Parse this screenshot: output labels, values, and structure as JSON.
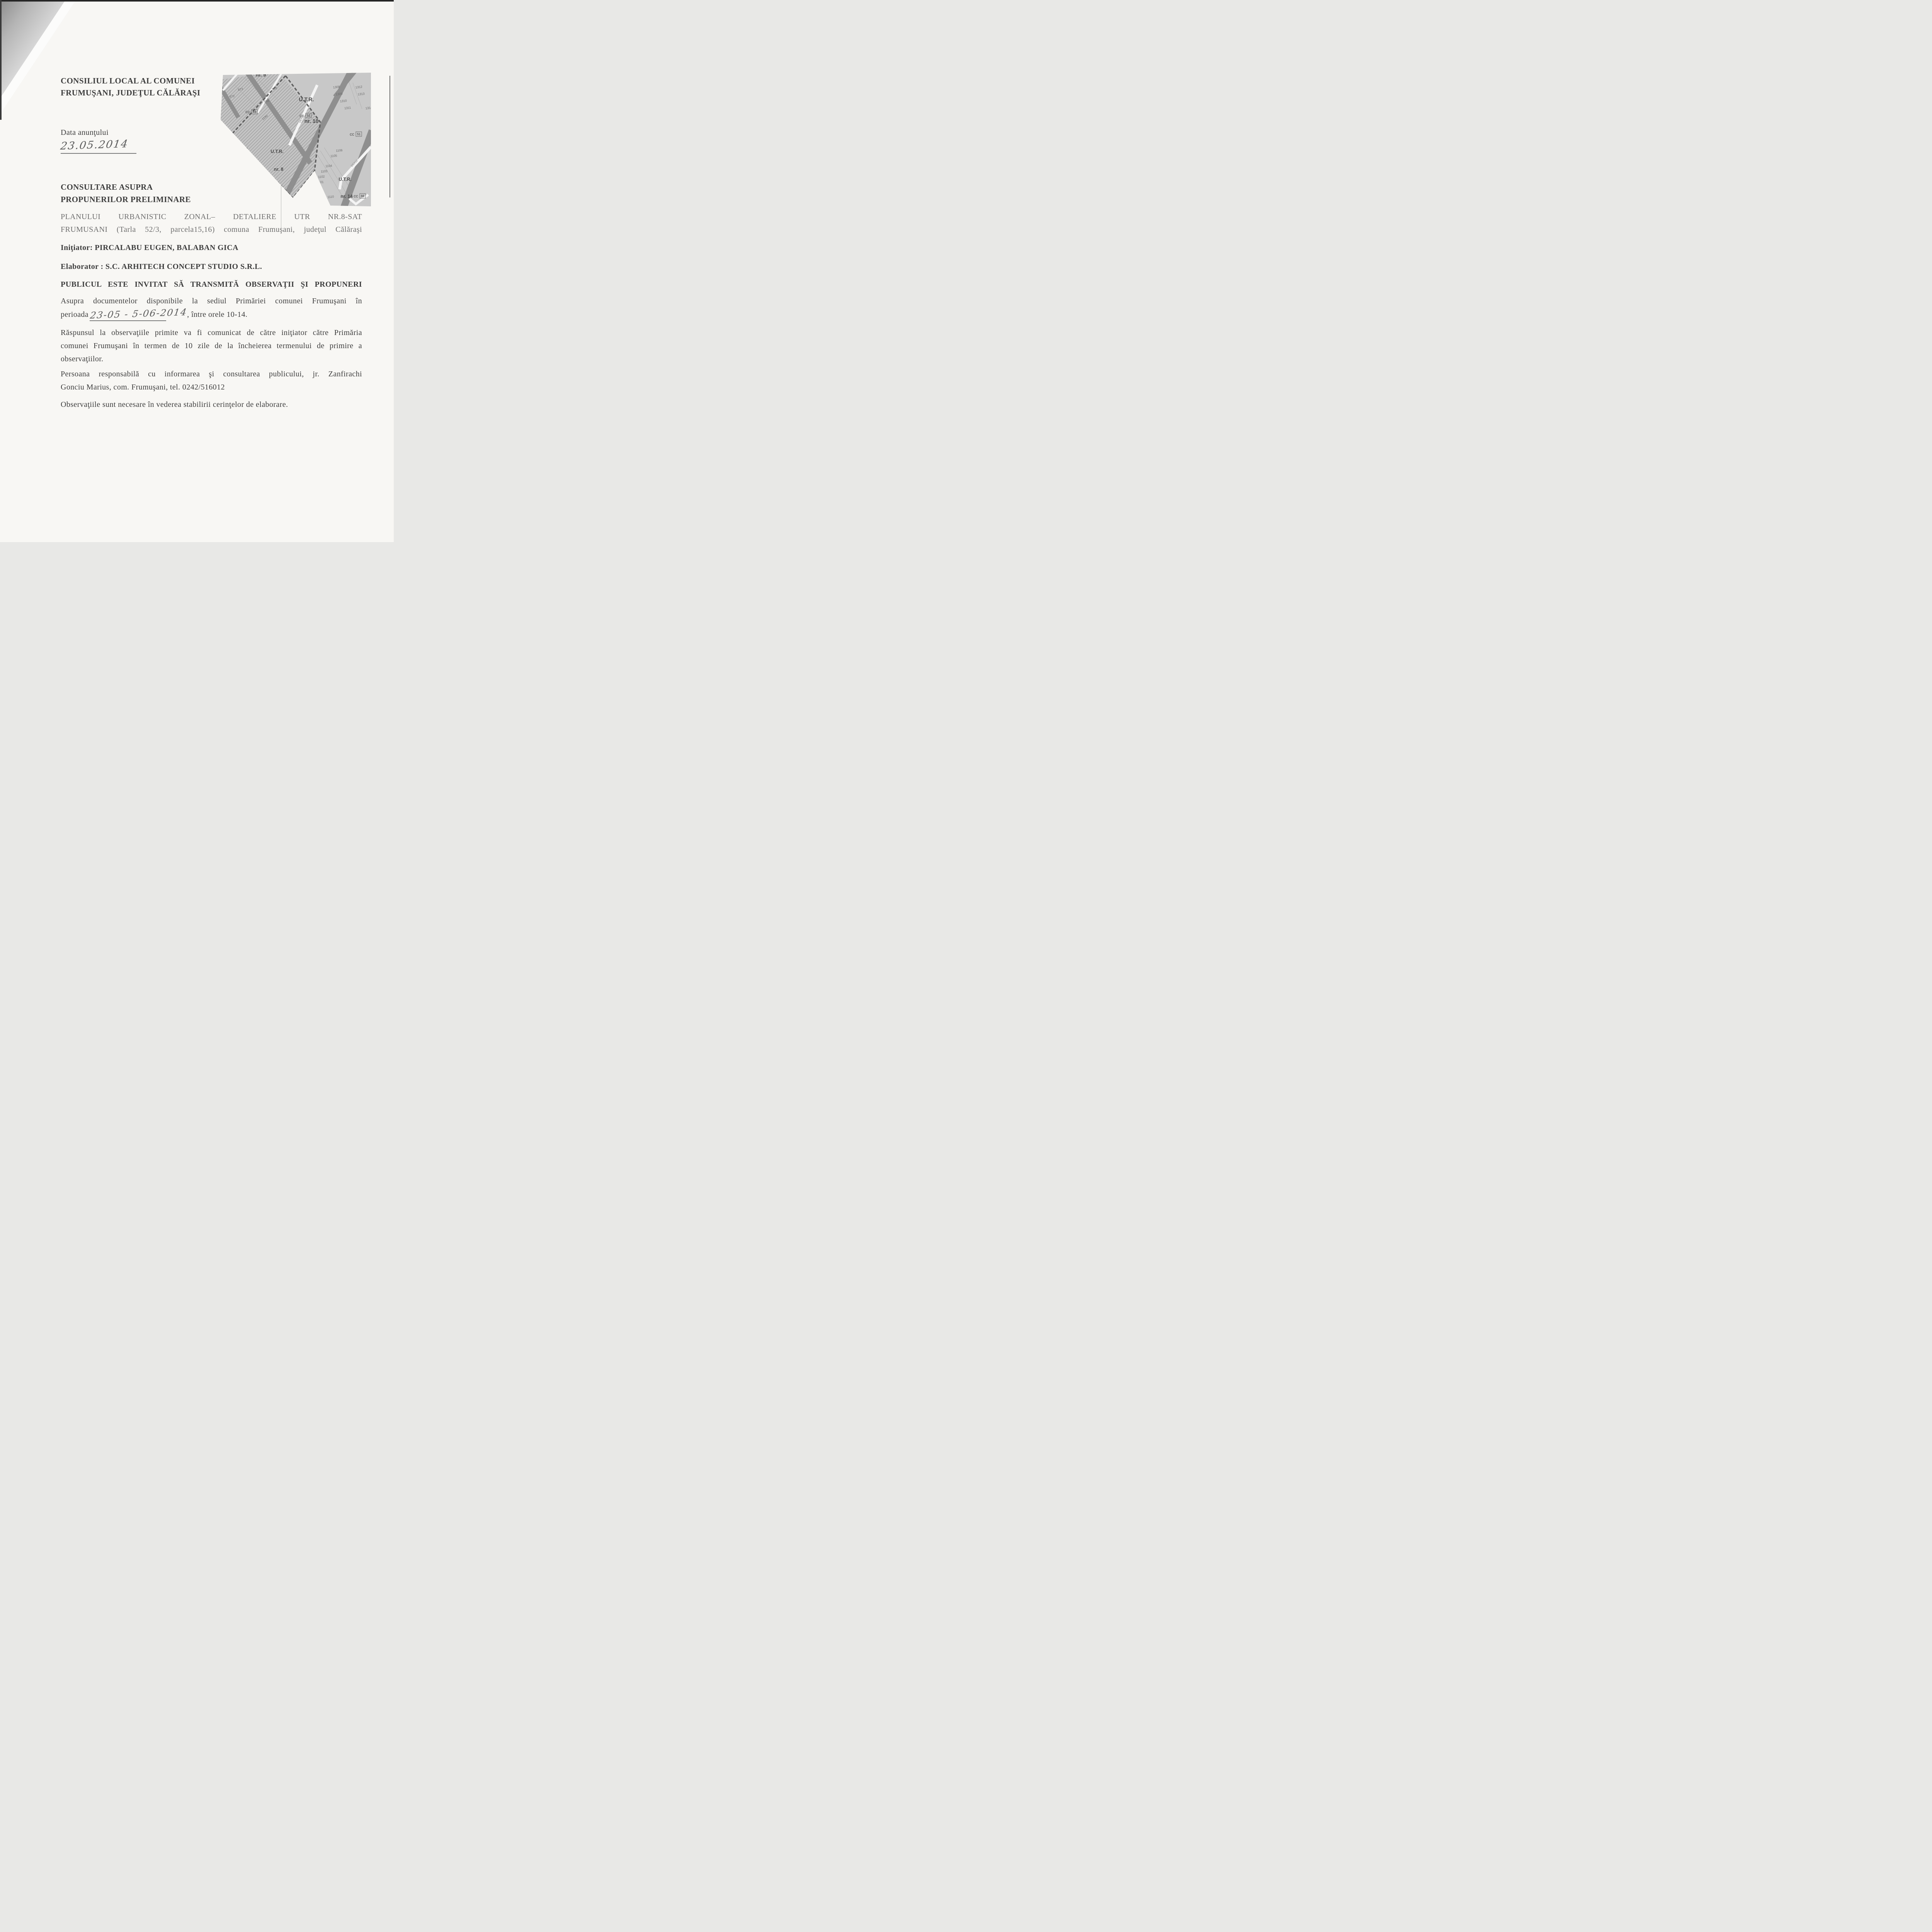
{
  "colors": {
    "paper": "#f8f7f4",
    "ink": "#3e3e3e",
    "faded_ink": "#6f6f6f",
    "handwriting": "#5d5d5d",
    "map_background": "#c8c8c8",
    "map_road": "#8f8f8f",
    "map_ink": "#474747"
  },
  "doc": {
    "header": [
      "CONSILIUL LOCAL AL COMUNEI",
      "FRUMUŞANI, JUDEŢUL CĂLĂRAŞI"
    ],
    "date_label": "Data anunţului",
    "date_handwritten": "23.05.2014",
    "section_title": [
      "CONSULTARE ASUPRA",
      "PROPUNERILOR PRELIMINARE"
    ],
    "plan_paragraph": [
      "PLANULUI URBANISTIC ZONAL– DETALIERE UTR NR.8-SAT",
      "FRUMUSANI (Tarla 52/3, parcela15,16) comuna Frumuşani, judeţul Călăraşi"
    ],
    "initiator": "Iniţiator: PIRCALABU EUGEN, BALABAN GICA",
    "elaborator": "Elaborator : S.C. ARHITECH CONCEPT STUDIO S.R.L.",
    "invitation": "PUBLICUL ESTE INVITAT SĂ TRANSMITĂ OBSERVAŢII ŞI PROPUNERI",
    "availability_line1": "Asupra documentelor disponibile la sediul Primăriei comunei Frumuşani în",
    "availability_prefix": "perioada",
    "availability_period_handwritten": "23-05 - 5-06-2014",
    "availability_suffix": ", între orele 10-14.",
    "response": [
      "Răspunsul la observaţiile primite va fi comunicat de către iniţiator către Primăria",
      "comunei Frumuşani în termen de 10 zile de la încheierea termenului de primire a",
      "observaţiilor."
    ],
    "contact": [
      "Persoana responsabilă cu informarea şi consultarea publicului, jr. Zanfirachi",
      "Gonciu Marius, com. Frumuşani, tel. 0242/516012"
    ],
    "closing_note": "Observaţiile sunt necesare în vederea stabilirii cerinţelor de elaborare."
  },
  "map": {
    "clipped_region_number": "nr. 9",
    "utr_regions": [
      {
        "prefix": "U.T.R.",
        "number": "nr. 7"
      },
      {
        "prefix": "U.T.R.",
        "number": "nr. 8"
      },
      {
        "prefix": "U.T.R.",
        "number": "nr. 10"
      },
      {
        "prefix": "U.T.R.",
        "number": "nr. 14"
      }
    ],
    "parcel_numbers": [
      "873",
      "872",
      "868",
      "878",
      "1190",
      "1308",
      "1309",
      "1310",
      "1311",
      "1312",
      "1313",
      "1314",
      "1106",
      "1105",
      "1104",
      "1103",
      "1102",
      "1101",
      "1110"
    ],
    "cc_labels": [
      {
        "prefix": "CC",
        "number": "54"
      },
      {
        "prefix": "CC",
        "number": "52"
      },
      {
        "prefix": "CC",
        "number": "51"
      },
      {
        "prefix": "CC",
        "number": "66"
      }
    ],
    "road_labels": [
      "DEX04",
      "DEX12"
    ]
  }
}
